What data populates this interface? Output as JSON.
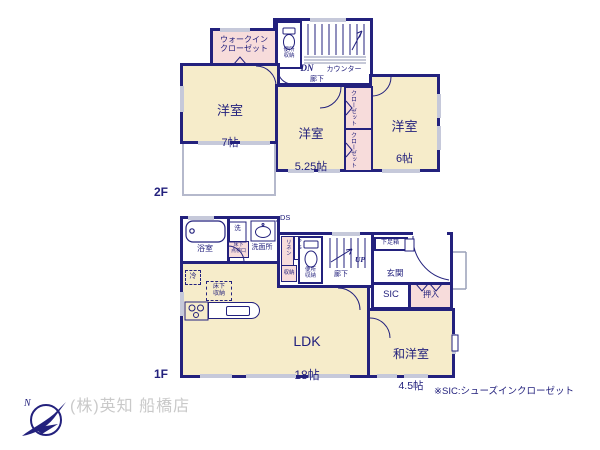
{
  "colors": {
    "wall": "#23217d",
    "room_fill": "#f6ecca",
    "closet_fill": "#f7dcdb",
    "window": "#c6c9da",
    "text": "#23217d",
    "company_text": "#c9c9c9",
    "balcony_line": "#b5b9cc"
  },
  "floor2": {
    "floor_label": "2F",
    "rooms": {
      "room7": {
        "name": "洋室",
        "size": "7帖"
      },
      "room525": {
        "name": "洋室",
        "size": "5.25帖"
      },
      "room6": {
        "name": "洋室",
        "size": "6帖"
      }
    },
    "wic_label": "ウォークイン\nクローゼット",
    "toilet_label": "便所\n収納",
    "closet1_label": "クローゼット",
    "closet2_label": "クローゼット",
    "dn_label": "DN",
    "counter_label": "カウンター",
    "hall_label": "廊下"
  },
  "floor1": {
    "floor_label": "1F",
    "rooms": {
      "ldk": {
        "name": "LDK",
        "size": "18帖"
      },
      "wayoshitsu": {
        "name": "和洋室",
        "size": "4.5帖"
      }
    },
    "bath_label": "浴室",
    "washer_label": "洗",
    "washroom_label": "洗面所",
    "hatch_label": "床下\n点検口",
    "ds_label": "DS",
    "linen_label": "リネン",
    "ps_label": "PS",
    "storage_label": "収納",
    "toilet_label": "便所\n収納",
    "hall_label": "廊下",
    "up_label": "UP",
    "entrance_label": "玄関",
    "shoebox_label": "下足箱",
    "sic_label": "SIC",
    "oshiire_label": "押入",
    "fridge_label": "冷",
    "underfloor_storage_label": "床下\n収納"
  },
  "footer": {
    "company_name": "(株)英知 船橋店",
    "sic_note": "※SIC:シューズインクローゼット"
  },
  "icons": {
    "compass": "north-compass-logo",
    "fixtures": [
      "bathtub-icon",
      "washer-icon",
      "sink-icon",
      "toilet-icon",
      "stove-icon",
      "kitchen-counter-icon",
      "stairs-icon",
      "door-arc-icon"
    ]
  }
}
